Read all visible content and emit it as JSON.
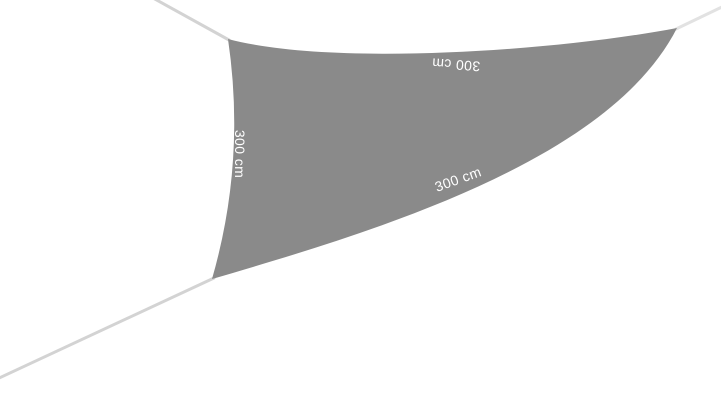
{
  "product_image": {
    "labels": {
      "left": "300 cm",
      "top": "300 cm",
      "bottom": "300 cm"
    },
    "colors": {
      "sail": "#8a8a8a",
      "rope": "#d3d3d3",
      "rope_light": "#e2e2e2",
      "label_text": "#ffffff",
      "background": "#ffffff"
    }
  }
}
